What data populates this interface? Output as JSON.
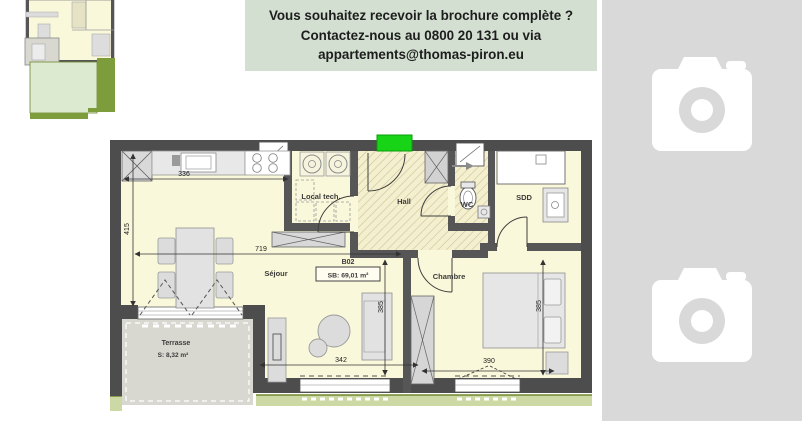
{
  "banner": {
    "line1": "Vous souhaitez recevoir la brochure complète ?",
    "line2": "Contactez-nous au 0800 20 131 ou via",
    "line3": "appartements@thomas-piron.eu"
  },
  "plan": {
    "unit": "B02",
    "surface": "SB: 69,01 m²",
    "rooms": {
      "sejour": "Séjour",
      "local_tech": "Local tech.",
      "hall": "Hall",
      "wc": "WC",
      "sdd": "SDD",
      "chambre": "Chambre",
      "terrasse": "Terrasse",
      "terrasse_surface": "S: 8,32 m²"
    },
    "dims": {
      "kitchen": "336",
      "left": "415",
      "sejour": "719",
      "window_sejour": "342",
      "window_chambre": "390",
      "sejour_depth": "385",
      "chambre_depth": "385"
    }
  },
  "photos": {
    "count": 2,
    "icon": "camera-icon"
  },
  "colors": {
    "banner_bg": "#d3e0d1",
    "entrance": "#17d417",
    "floor": "#faf8da",
    "wall": "#4d4d4d",
    "terrace": "#d8d8d0",
    "garden_light": "#dcead0",
    "garden_dark": "#7d9c3c",
    "placeholder": "#d9d9d9"
  }
}
